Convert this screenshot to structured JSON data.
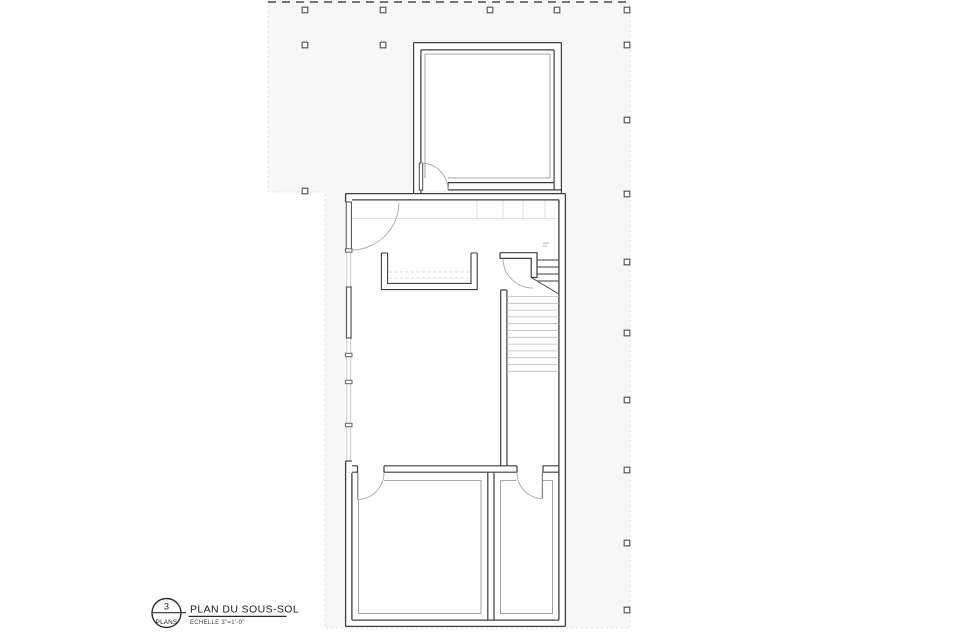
{
  "drawing": {
    "sheet_number": "3",
    "sheet_label": "PLANS",
    "title": "PLAN DU SOUS-SOL",
    "scale_note": "ECHELLE 3\"=1'-0\""
  },
  "colors": {
    "paper": "#ffffff",
    "site_zone_fill": "#f7f7f7",
    "site_zone_edge": "#e0e0e0",
    "wall_line": "#3e3e3e",
    "finish_line": "#8a8a8a",
    "window_light_line": "#b8b8b8",
    "window_dark_line": "#5a5a5a",
    "door_arc": "#a8a8a8",
    "faint_overhead_line": "#d8d8d8",
    "faint_tread_line": "#bcbcbc",
    "grid_marker": "#5a5a5a",
    "boundary_dash": "#4a4a4a"
  }
}
